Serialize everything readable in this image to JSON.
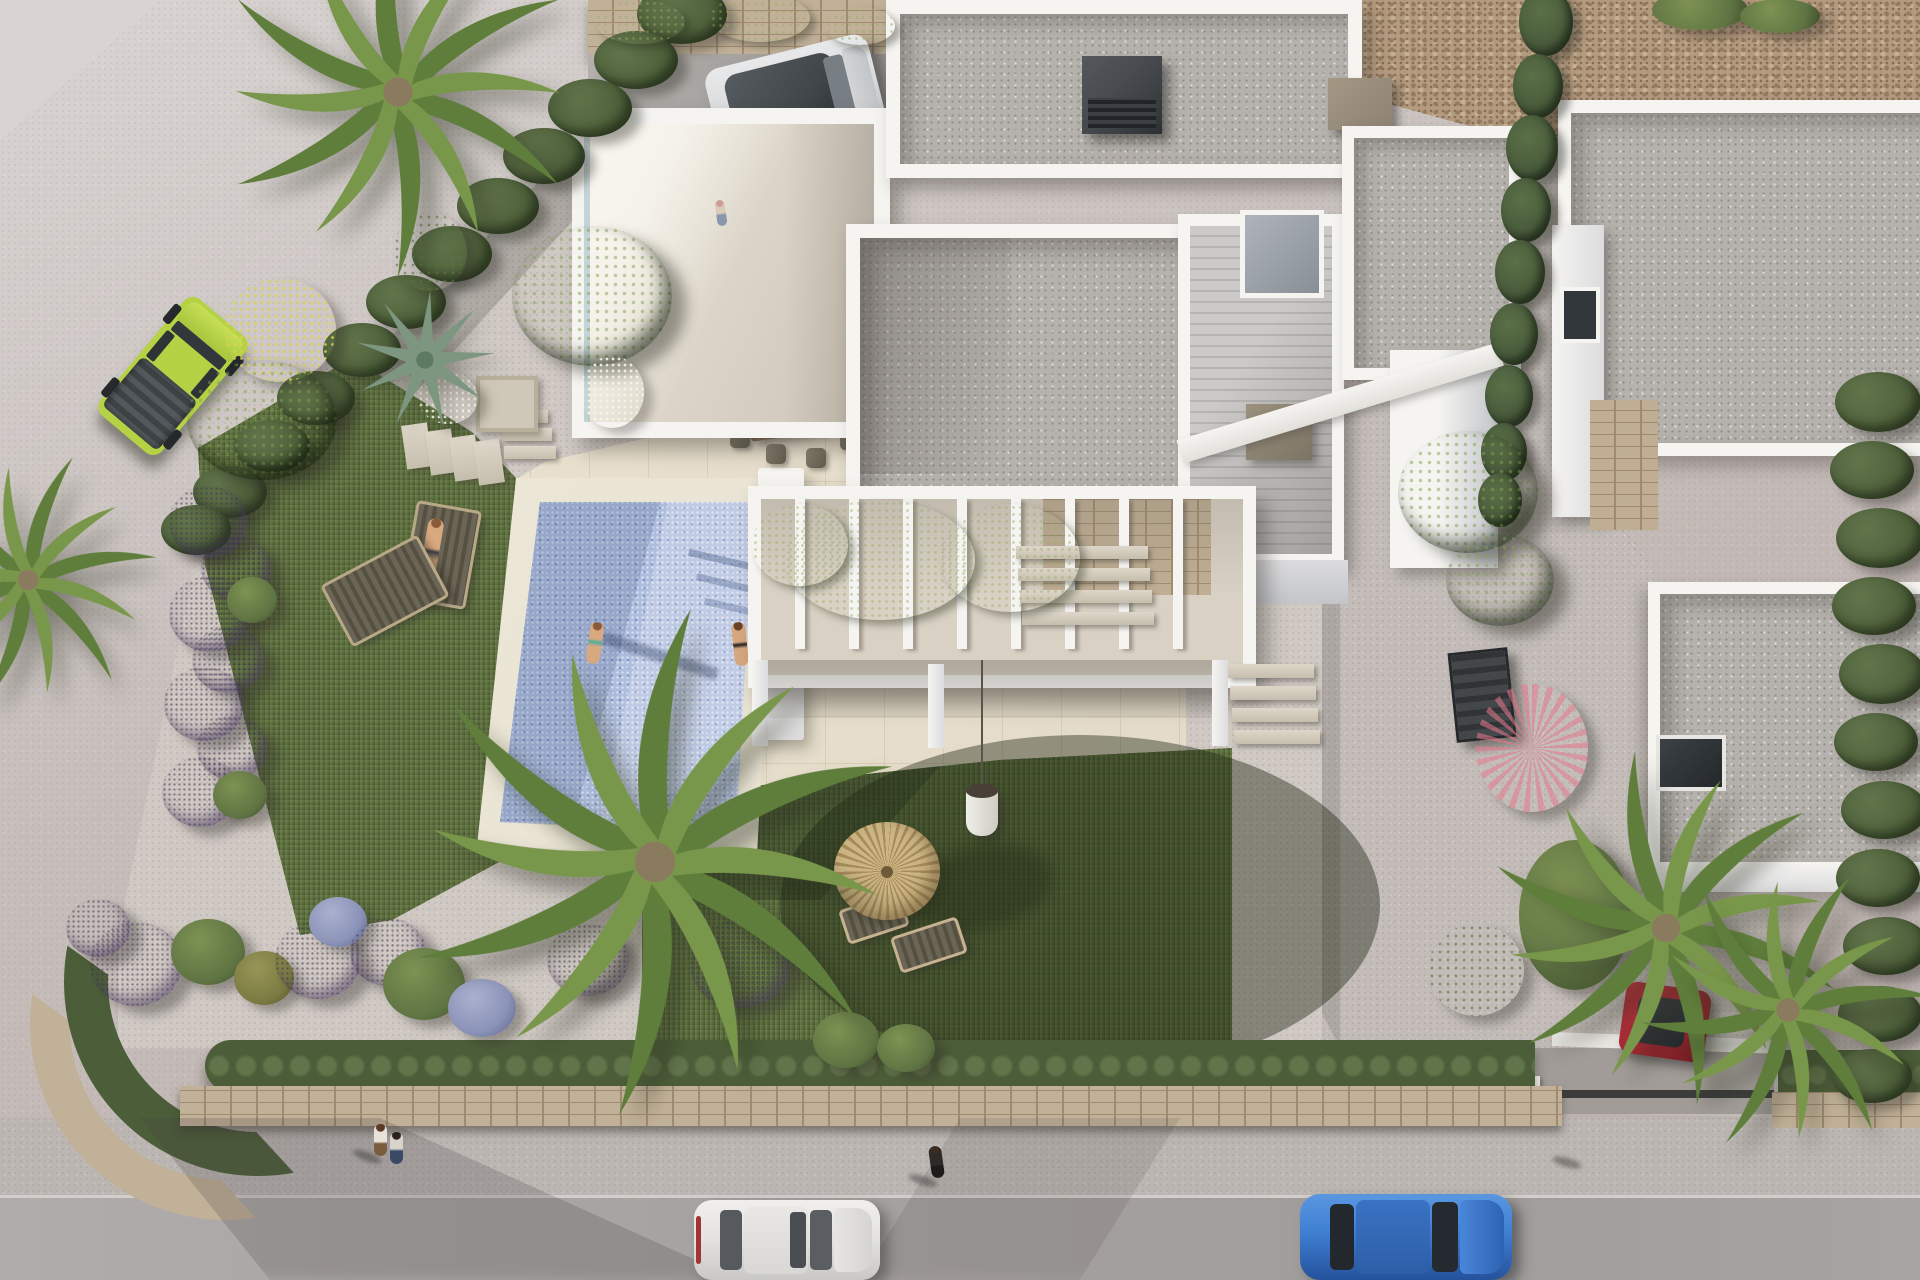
{
  "scene": {
    "title": "aerial-3d-render-modern-villa-with-pool",
    "description": "Top-down architectural 3D rendering of a white modern villa plot: flat gravel roofs, roof terrace, vine-covered pergola, rectangular mosaic pool with swimmers, lawn with lavender ball bushes and palms, thatched umbrella, gravel driveway, neighbouring villa, and a street at the bottom with parked cars and pedestrians.",
    "time_of_day": "late afternoon sun from the west casting long shadows"
  },
  "palette": {
    "road_light": "#d9d4d2",
    "road_base": "#c8c0bd",
    "road_dark": "#b9aeab",
    "street": "#a8a4a3",
    "sidewalk": "#bcb6b3",
    "curb": "#d3cecb",
    "rock": "#b49a7e",
    "rock_dark": "#947c5f",
    "stone_wall": "#c2b199",
    "stone_joint": "#a08b6e",
    "garden_gravel": "#cfc8c3",
    "driveway": "#c3bcb8",
    "drive_entry": "#a29c98",
    "travertine": "#e4dcc9",
    "trav_line": "#c9bfa6",
    "lawn": "#5d6f40",
    "lawn_light": "#71834c",
    "lawn_dark": "#41502e",
    "pool": "#aebdde",
    "pool_light": "#ccd8ef",
    "pool_dark": "#8fa3cc",
    "coping": "#e8e2d2",
    "white_sun": "#f5f4f1",
    "white_shade": "#dcdcde",
    "white_dark": "#c3c5c9",
    "roof_gravel": "#b5b1ac",
    "wood_deck": "#c2c1bf",
    "terr_floor": "#ddd6c9",
    "perg_floor": "#d9d2c4",
    "stone_feat": "#bfae93",
    "vine": "#54673c",
    "hedge_dark": "#4c5e39",
    "hedge_mid": "#61744a",
    "bush_green": "#5f7443",
    "bush_olive": "#7a7a42",
    "purple": "#b2a2c6",
    "purple_dark": "#8e7aa8",
    "lavblue": "#8b93b8",
    "magenta": "#b8509a",
    "boug": "#a05ec2",
    "coral": "#d4697c",
    "cypress": "#46583a",
    "palm_green": "#5f7e3b",
    "palm_yellow": "#8aa352",
    "thatch": "#cdb684",
    "thatch_dark": "#a78d5c",
    "wood_furn": "#7b6048",
    "cushion": "#5c584d",
    "jeep": "#b5d244",
    "suv_silver": "#d9dadc",
    "suv_roof": "#41464a",
    "car_white": "#e3e2e0",
    "car_blue": "#3f7fd2",
    "car_red": "#9e2631",
    "glass": "#32373c",
    "skin": "#d8a87f",
    "chim_dark": "#43474b",
    "chim_tan": "#8d8273",
    "metal": "#3b3e40"
  },
  "inventory": {
    "vehicles": [
      {
        "label": "lime-green offroad jeep",
        "color": "jeep",
        "where": "parked on road upper-left"
      },
      {
        "label": "two-tone silver suv",
        "color": "suv_silver",
        "where": "carport top-center"
      },
      {
        "label": "white hatchback",
        "color": "car_white",
        "where": "street bottom-center"
      },
      {
        "label": "blue crossover",
        "color": "car_blue",
        "where": "street bottom-right"
      },
      {
        "label": "dark red car",
        "color": "car_red",
        "where": "driveway under palms"
      }
    ],
    "people": [
      {
        "label": "man with child",
        "where": "roof terrace"
      },
      {
        "label": "seated woman",
        "where": "dining terrace"
      },
      {
        "label": "sunbathing man",
        "where": "lounger beside pool"
      },
      {
        "label": "woman standing",
        "where": "inside pool"
      },
      {
        "label": "woman sitting",
        "where": "pool edge"
      },
      {
        "label": "walking couple",
        "where": "sidewalk bottom-left"
      },
      {
        "label": "pedestrian in dark clothes",
        "where": "sidewalk bottom-center"
      },
      {
        "label": "pedestrian in white top",
        "where": "sidewalk bottom-right"
      }
    ],
    "structures": [
      "main white villa with flat gravel roofs",
      "roof terrace with glass balustrade",
      "vine-covered white pergola",
      "carport with stone back wall",
      "rectangular mosaic pool with travertine coping",
      "neighbouring white villa with stone accents",
      "perimeter stone wall topped with hedge",
      "thatched palapa umbrella with two loungers"
    ]
  },
  "vegetation": {
    "clusters": [
      {
        "n": "hedge-blob",
        "c": "veg-hedge",
        "x": 682,
        "y": 14,
        "w": 90,
        "h": 60
      },
      {
        "n": "hedge-blob",
        "c": "veg-hedge",
        "x": 636,
        "y": 60,
        "w": 84,
        "h": 58
      },
      {
        "n": "hedge-blob",
        "c": "veg-hedge",
        "x": 590,
        "y": 108,
        "w": 84,
        "h": 58
      },
      {
        "n": "hedge-blob",
        "c": "veg-hedge",
        "x": 544,
        "y": 156,
        "w": 82,
        "h": 56
      },
      {
        "n": "hedge-blob",
        "c": "veg-hedge",
        "x": 498,
        "y": 206,
        "w": 82,
        "h": 56
      },
      {
        "n": "hedge-blob",
        "c": "veg-hedge",
        "x": 452,
        "y": 254,
        "w": 80,
        "h": 56
      },
      {
        "n": "hedge-blob",
        "c": "veg-hedge",
        "x": 406,
        "y": 302,
        "w": 80,
        "h": 54
      },
      {
        "n": "hedge-blob",
        "c": "veg-hedge",
        "x": 362,
        "y": 350,
        "w": 78,
        "h": 54
      },
      {
        "n": "hedge-blob",
        "c": "veg-hedge",
        "x": 316,
        "y": 398,
        "w": 78,
        "h": 54
      },
      {
        "n": "hedge-blob",
        "c": "veg-hedge",
        "x": 272,
        "y": 446,
        "w": 76,
        "h": 52
      },
      {
        "n": "hedge-blob",
        "c": "veg-hedge",
        "x": 230,
        "y": 492,
        "w": 74,
        "h": 52
      },
      {
        "n": "hedge-blob",
        "c": "veg-hedge",
        "x": 196,
        "y": 530,
        "w": 70,
        "h": 50
      },
      {
        "n": "bougainvillea",
        "c": "veg-boug",
        "x": 430,
        "y": 252,
        "w": 74,
        "h": 78
      },
      {
        "n": "yellow-shrub",
        "c": "veg-yellow",
        "x": 280,
        "y": 330,
        "w": 112,
        "h": 104
      },
      {
        "n": "tree",
        "c": "veg-tree",
        "x": 262,
        "y": 420,
        "w": 150,
        "h": 120
      },
      {
        "n": "tree",
        "c": "veg-tree",
        "x": 592,
        "y": 296,
        "w": 160,
        "h": 140
      },
      {
        "n": "white-bush",
        "c": "veg-white",
        "x": 448,
        "y": 398,
        "w": 60,
        "h": 52
      },
      {
        "n": "white-bush",
        "c": "veg-white",
        "x": 612,
        "y": 392,
        "w": 64,
        "h": 72
      },
      {
        "n": "purple-ball",
        "c": "veg-purple",
        "x": 208,
        "y": 522,
        "w": 78,
        "h": 72
      },
      {
        "n": "purple-ball",
        "c": "veg-purple",
        "x": 236,
        "y": 568,
        "w": 70,
        "h": 64
      },
      {
        "n": "purple-ball",
        "c": "veg-purple",
        "x": 210,
        "y": 614,
        "w": 82,
        "h": 76
      },
      {
        "n": "green-ball",
        "c": "veg-green",
        "x": 252,
        "y": 600,
        "w": 50,
        "h": 46
      },
      {
        "n": "purple-ball",
        "c": "veg-purple",
        "x": 228,
        "y": 660,
        "w": 72,
        "h": 66
      },
      {
        "n": "purple-ball",
        "c": "veg-purple",
        "x": 204,
        "y": 704,
        "w": 80,
        "h": 74
      },
      {
        "n": "purple-ball",
        "c": "veg-purple",
        "x": 232,
        "y": 748,
        "w": 70,
        "h": 64
      },
      {
        "n": "purple-ball",
        "c": "veg-purple",
        "x": 200,
        "y": 792,
        "w": 76,
        "h": 70
      },
      {
        "n": "green-ball",
        "c": "veg-green",
        "x": 240,
        "y": 795,
        "w": 54,
        "h": 48
      },
      {
        "n": "purple-ball",
        "c": "veg-purple",
        "x": 98,
        "y": 928,
        "w": 64,
        "h": 58
      },
      {
        "n": "purple-ball",
        "c": "veg-purple",
        "x": 136,
        "y": 964,
        "w": 92,
        "h": 84
      },
      {
        "n": "green-ball",
        "c": "veg-green",
        "x": 208,
        "y": 952,
        "w": 74,
        "h": 66
      },
      {
        "n": "olive-ball",
        "c": "veg-olive",
        "x": 264,
        "y": 978,
        "w": 60,
        "h": 54
      },
      {
        "n": "purple-ball",
        "c": "veg-purple",
        "x": 318,
        "y": 960,
        "w": 86,
        "h": 78
      },
      {
        "n": "lavender-shrub",
        "c": "veg-lavblue",
        "x": 338,
        "y": 922,
        "w": 58,
        "h": 50
      },
      {
        "n": "purple-ball",
        "c": "veg-purple",
        "x": 388,
        "y": 952,
        "w": 76,
        "h": 68
      },
      {
        "n": "green-ball",
        "c": "veg-green",
        "x": 424,
        "y": 984,
        "w": 82,
        "h": 72
      },
      {
        "n": "lavender-shrub",
        "c": "veg-lavblue",
        "x": 482,
        "y": 1008,
        "w": 68,
        "h": 58
      },
      {
        "n": "purple-ball",
        "c": "veg-purple",
        "x": 588,
        "y": 960,
        "w": 82,
        "h": 72
      },
      {
        "n": "purple-ball",
        "c": "veg-purple",
        "x": 740,
        "y": 964,
        "w": 100,
        "h": 88
      },
      {
        "n": "green-bush",
        "c": "veg-green",
        "x": 846,
        "y": 1040,
        "w": 66,
        "h": 56
      },
      {
        "n": "green-bush",
        "c": "veg-green",
        "x": 906,
        "y": 1048,
        "w": 58,
        "h": 48
      },
      {
        "n": "pergola-vine",
        "c": "veg-vine",
        "x": 880,
        "y": 560,
        "w": 190,
        "h": 120
      },
      {
        "n": "pergola-vine",
        "c": "veg-vine",
        "x": 1010,
        "y": 558,
        "w": 140,
        "h": 108
      },
      {
        "n": "pergola-vine",
        "c": "veg-vine",
        "x": 800,
        "y": 545,
        "w": 96,
        "h": 82
      },
      {
        "n": "carport-vine",
        "c": "veg-vine",
        "x": 640,
        "y": 22,
        "w": 90,
        "h": 44
      },
      {
        "n": "carport-vine",
        "c": "veg-vine",
        "x": 760,
        "y": 18,
        "w": 100,
        "h": 48
      },
      {
        "n": "carport-vine",
        "c": "veg-vine",
        "x": 860,
        "y": 26,
        "w": 70,
        "h": 38
      },
      {
        "n": "cypress",
        "c": "veg-cypress",
        "x": 1546,
        "y": 22,
        "w": 54,
        "h": 68
      },
      {
        "n": "cypress",
        "c": "veg-cypress",
        "x": 1538,
        "y": 86,
        "w": 50,
        "h": 64
      },
      {
        "n": "cypress",
        "c": "veg-cypress",
        "x": 1532,
        "y": 148,
        "w": 52,
        "h": 66
      },
      {
        "n": "cypress",
        "c": "veg-cypress",
        "x": 1526,
        "y": 210,
        "w": 50,
        "h": 64
      },
      {
        "n": "cypress",
        "c": "veg-cypress",
        "x": 1520,
        "y": 272,
        "w": 50,
        "h": 64
      },
      {
        "n": "cypress",
        "c": "veg-cypress",
        "x": 1514,
        "y": 334,
        "w": 48,
        "h": 62
      },
      {
        "n": "cypress",
        "c": "veg-cypress",
        "x": 1509,
        "y": 396,
        "w": 48,
        "h": 62
      },
      {
        "n": "cypress",
        "c": "veg-cypress",
        "x": 1504,
        "y": 452,
        "w": 46,
        "h": 58
      },
      {
        "n": "cypress",
        "c": "veg-cypress",
        "x": 1500,
        "y": 500,
        "w": 44,
        "h": 54
      },
      {
        "n": "tree",
        "c": "veg-tree",
        "x": 1468,
        "y": 492,
        "w": 140,
        "h": 122
      },
      {
        "n": "tree",
        "c": "veg-tree",
        "x": 1500,
        "y": 580,
        "w": 108,
        "h": 92
      },
      {
        "n": "coral-plant",
        "c": "veg-coral",
        "x": 1532,
        "y": 748,
        "w": 112,
        "h": 128
      },
      {
        "n": "schefflera",
        "c": "veg-green",
        "x": 1575,
        "y": 915,
        "w": 112,
        "h": 150
      },
      {
        "n": "bougainvillea",
        "c": "veg-magenta",
        "x": 1476,
        "y": 970,
        "w": 96,
        "h": 92
      },
      {
        "n": "hedge-blob",
        "c": "veg-hedge",
        "x": 1878,
        "y": 402,
        "w": 86,
        "h": 60
      },
      {
        "n": "hedge-blob",
        "c": "veg-hedge",
        "x": 1872,
        "y": 470,
        "w": 84,
        "h": 58
      },
      {
        "n": "hedge-blob",
        "c": "veg-hedge",
        "x": 1880,
        "y": 538,
        "w": 88,
        "h": 60
      },
      {
        "n": "hedge-blob",
        "c": "veg-hedge",
        "x": 1874,
        "y": 606,
        "w": 84,
        "h": 58
      },
      {
        "n": "hedge-blob",
        "c": "veg-hedge",
        "x": 1882,
        "y": 674,
        "w": 86,
        "h": 60
      },
      {
        "n": "hedge-blob",
        "c": "veg-hedge",
        "x": 1876,
        "y": 742,
        "w": 84,
        "h": 58
      },
      {
        "n": "hedge-blob",
        "c": "veg-hedge",
        "x": 1884,
        "y": 810,
        "w": 86,
        "h": 58
      },
      {
        "n": "hedge-blob",
        "c": "veg-hedge",
        "x": 1878,
        "y": 878,
        "w": 84,
        "h": 58
      },
      {
        "n": "hedge-blob",
        "c": "veg-hedge",
        "x": 1886,
        "y": 946,
        "w": 86,
        "h": 58
      },
      {
        "n": "hedge-blob",
        "c": "veg-hedge",
        "x": 1880,
        "y": 1014,
        "w": 84,
        "h": 56
      },
      {
        "n": "hedge-blob",
        "c": "veg-hedge",
        "x": 1872,
        "y": 1076,
        "w": 80,
        "h": 54
      },
      {
        "n": "green-top",
        "c": "veg-green",
        "x": 1700,
        "y": 10,
        "w": 96,
        "h": 40
      },
      {
        "n": "green-top",
        "c": "veg-green",
        "x": 1780,
        "y": 16,
        "w": 80,
        "h": 34
      }
    ]
  }
}
